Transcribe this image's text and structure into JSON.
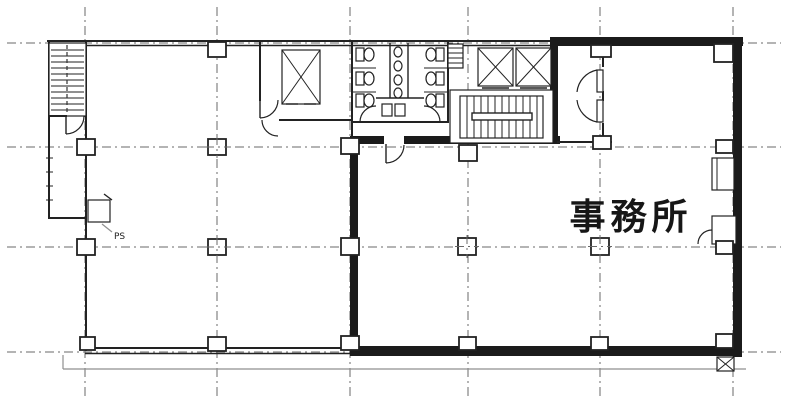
{
  "labels": {
    "office": "事務所",
    "pipe_shaft": "PS"
  },
  "colors": {
    "background": "#ffffff",
    "wall": "#222222",
    "wall_thick": "#1b1b1b",
    "grid": "#686868",
    "light_line": "#8f8f8f"
  },
  "plan": {
    "grid_x": [
      85,
      217,
      350,
      468,
      600,
      733
    ],
    "grid_y": [
      43,
      147,
      247,
      352
    ],
    "columns": [
      [
        208,
        42,
        18,
        15,
        0
      ],
      [
        591,
        45,
        20,
        12,
        0
      ],
      [
        714,
        44,
        19,
        18,
        0
      ],
      [
        77,
        139,
        18,
        16,
        0
      ],
      [
        208,
        139,
        18,
        16,
        1
      ],
      [
        341,
        138,
        18,
        16,
        0
      ],
      [
        459,
        145,
        18,
        16,
        0
      ],
      [
        593,
        136,
        18,
        13,
        0
      ],
      [
        716,
        140,
        17,
        13,
        0
      ],
      [
        77,
        239,
        18,
        16,
        0
      ],
      [
        208,
        239,
        18,
        16,
        1
      ],
      [
        341,
        238,
        18,
        17,
        0
      ],
      [
        458,
        238,
        18,
        17,
        1
      ],
      [
        591,
        238,
        18,
        17,
        1
      ],
      [
        716,
        241,
        17,
        13,
        0
      ],
      [
        80,
        337,
        15,
        13,
        0
      ],
      [
        208,
        337,
        18,
        14,
        0
      ],
      [
        341,
        336,
        18,
        14,
        0
      ],
      [
        459,
        337,
        17,
        13,
        0
      ],
      [
        591,
        337,
        17,
        13,
        0
      ],
      [
        716,
        334,
        17,
        14,
        0
      ]
    ],
    "features": [
      "staircase-north-west",
      "staircase-core",
      "elevator-west",
      "elevator-pair-east",
      "toilets",
      "duct-shaft",
      "pipe-shaft",
      "office-area",
      "entry-vestibule",
      "wall-equipment-units",
      "tenant-boundary-thick-wall"
    ]
  }
}
